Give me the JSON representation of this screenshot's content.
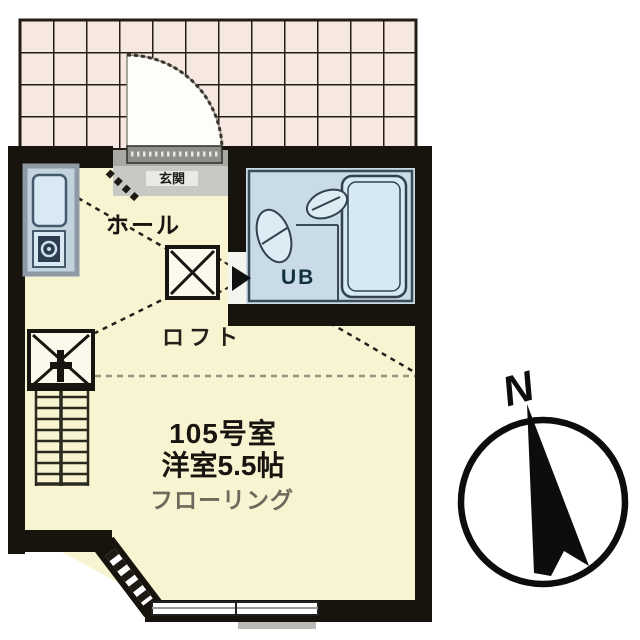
{
  "page": {
    "kind": "japanese-apartment-floor-plan",
    "background": "#ffffff"
  },
  "labels": {
    "room_number": "105号室",
    "room_type": "洋室5.5帖",
    "flooring": "フローリング",
    "hall": "ホール",
    "loft": "ロフト",
    "entrance": "玄関",
    "unit_bath": "UB",
    "compass_north": "N"
  },
  "colors": {
    "wall": "#17130d",
    "room_floor": "#f8f3d0",
    "tile": "#f6e8e1",
    "tile_line": "#241d16",
    "unit_bath_fill": "#c9dbe7",
    "fixture_fill": "#dcebf4",
    "fixture_line": "#31424e",
    "entrance_floor": "#c8c8c4",
    "flooring_text": "#6d695d",
    "compass": "#0d0d0d"
  },
  "fixtures": [
    "entrance-door",
    "kitchen-sink",
    "gas-stove",
    "toilet",
    "wash-basin",
    "bathtub",
    "staircase",
    "loft-hatch",
    "sliding-window",
    "corner-window",
    "compass"
  ]
}
